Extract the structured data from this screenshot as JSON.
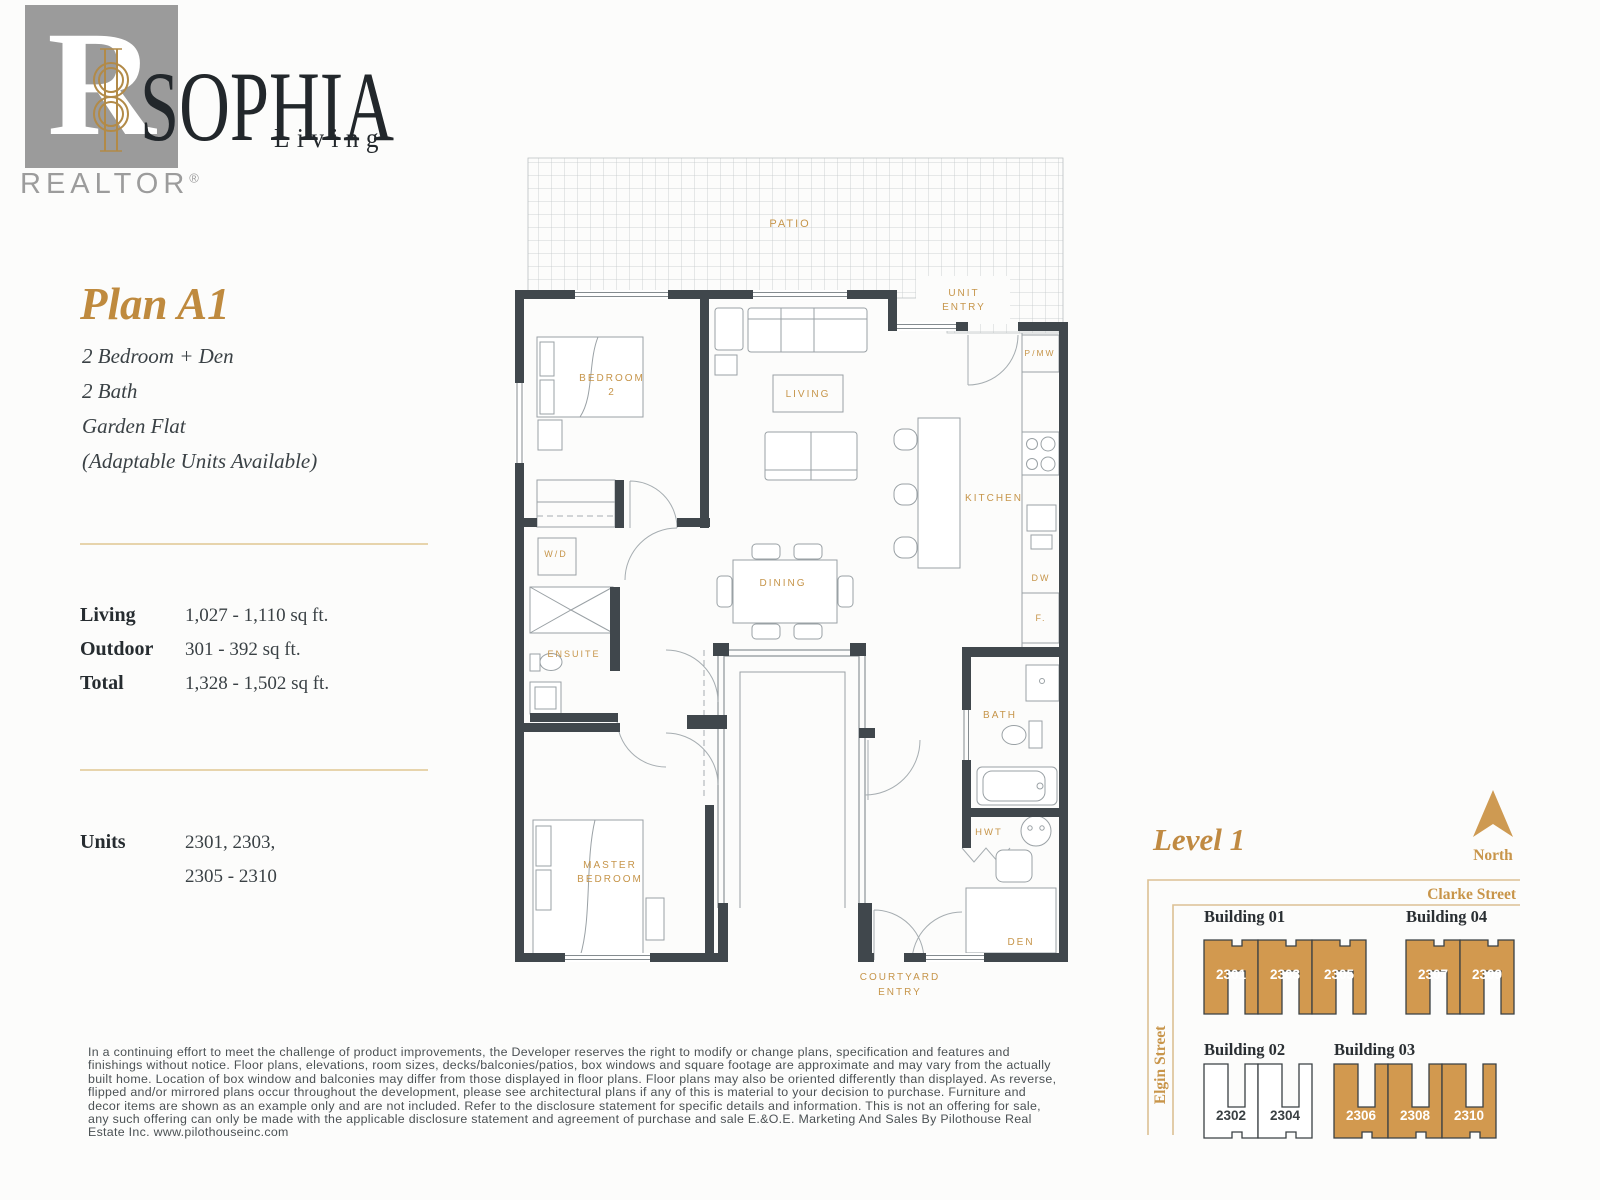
{
  "brand": {
    "realtor_letter": "R",
    "realtor_word": "REALTOR",
    "registered": "®",
    "name": "SOPHIA",
    "tagline": "Living"
  },
  "plan": {
    "title": "Plan A1",
    "features": [
      "2 Bedroom + Den",
      "2 Bath",
      "Garden Flat",
      "(Adaptable Units Available)"
    ],
    "stats": [
      {
        "label": "Living",
        "value": "1,027 - 1,110 sq ft."
      },
      {
        "label": "Outdoor",
        "value": "301 - 392 sq ft."
      },
      {
        "label": "Total",
        "value": "1,328 - 1,502 sq ft."
      }
    ],
    "units_label": "Units",
    "units_line1": "2301, 2303,",
    "units_line2": "2305 - 2310"
  },
  "floorplan": {
    "patio": "PATIO",
    "unit_entry1": "UNIT",
    "unit_entry2": "ENTRY",
    "bedroom2_1": "BEDROOM",
    "bedroom2_2": "2",
    "living": "LIVING",
    "pmw": "P/MW",
    "kitchen": "KITCHEN",
    "wd": "W/D",
    "dining": "DINING",
    "ensuite": "ENSUITE",
    "dw": "DW",
    "f": "F.",
    "bath": "BATH",
    "hwt": "HWT",
    "master1": "MASTER",
    "master2": "BEDROOM",
    "den": "DEN",
    "courtyard1": "COURTYARD",
    "courtyard2": "ENTRY"
  },
  "sitemap": {
    "title": "Level 1",
    "north": "North",
    "street_top": "Clarke Street",
    "street_left": "Elgin Street",
    "buildings": [
      {
        "label": "Building 01",
        "units": [
          "2301",
          "2303",
          "2305"
        ]
      },
      {
        "label": "Building 04",
        "units": [
          "2307",
          "2309"
        ]
      },
      {
        "label": "Building 02",
        "units": [
          "2302",
          "2304"
        ]
      },
      {
        "label": "Building 03",
        "units": [
          "2306",
          "2308",
          "2310"
        ]
      }
    ]
  },
  "disclaimer": "In a continuing effort to meet the challenge of product improvements, the Developer reserves the right to modify or change plans, specification and features and finishings without notice. Floor plans, elevations, room sizes, decks/balconies/patios, box windows and square footage are approximate and may vary from the actually built home. Location of box window and balconies may differ from those displayed in floor plans. Floor plans may also be oriented differently than displayed. As reverse, flipped and/or mirrored plans occur throughout the development, please see architectural plans if any of this is material to your decision to purchase. Furniture and decor items are shown as an example only and are not included. Refer to the disclosure statement for specific details and information. This is not an offering for sale, any such offering can only be made with the applicable disclosure statement and agreement of purchase and sale E.&O.E. Marketing And Sales By Pilothouse Real Estate Inc. www.pilothouseinc.com",
  "colors": {
    "accent_gold": "#bf8a3e",
    "label_gold": "#c6954a",
    "wall": "#40474c",
    "building_fill": "#d2994f",
    "divider": "#e7d4ac",
    "logo_gray": "#9b9b9b"
  }
}
